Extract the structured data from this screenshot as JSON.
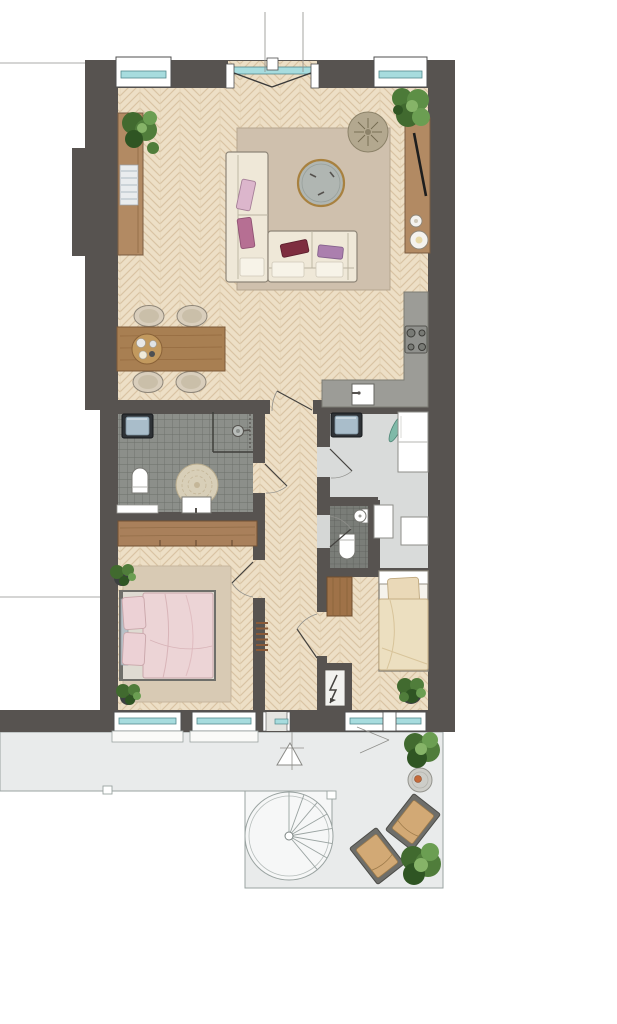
{
  "plan": {
    "type": "apartment-floor-plan",
    "palette": {
      "background": "#ffffff",
      "wall": "#575350",
      "wood_floor": "#eddfc6",
      "wood_floor_line": "#d9c3a3",
      "bath_tile": "#8c8f8a",
      "bath_tile_line": "#6d706b",
      "wc_tile": "#7a7d78",
      "wc_tile_line": "#5c5f5a",
      "utility_floor": "#d9dbda",
      "terrace_floor": "#e9ebeb",
      "outline": "#9aa3a1",
      "window_glass": "#a7dcde",
      "window_frame": "#4f4f4f",
      "wood_furniture": "#b28a63",
      "wood_dark": "#9f7248",
      "table_wood": "#a87f52",
      "counter": "#9c9c97",
      "sofa": "#efe8d8",
      "rug_living": "#cfc0ad",
      "rug_bedroom": "#d8cab4",
      "duvet_pink": "#ecd4d6",
      "duvet_beige": "#ecdfc0",
      "pillow_pink": "#dcb6cc",
      "pillow_mauve": "#b66f93",
      "pillow_wine": "#7e2d3f",
      "pillow_purple": "#ab7fae",
      "plant_green": "#507d3b",
      "plant_green_light": "#6b9e52",
      "pot_dark": "#3c4040",
      "appliance_frame": "#2e3236",
      "appliance_door": "#a9bdca",
      "chair_cushion": "#d2a975",
      "chair_frame": "#6e6e6a",
      "gold_rim": "#a8813f"
    },
    "rooms": [
      {
        "name": "living-room",
        "floor": "herringbone-parquet",
        "furniture": [
          "corner-sofa",
          "round-coffee-table",
          "area-rug",
          "rattan-pouf",
          "sideboard",
          "magazine-stack",
          "dining-table",
          "four-dining-chairs",
          "serving-tray",
          "tv-cabinet",
          "tv",
          "two-speakers",
          "two-plants"
        ]
      },
      {
        "name": "kitchen",
        "floor": "herringbone-parquet",
        "furniture": [
          "l-shaped-counter",
          "cooktop-four-burners",
          "sink-with-faucet"
        ]
      },
      {
        "name": "bathroom",
        "floor": "grey-tiles",
        "furniture": [
          "washing-machine",
          "shower-head",
          "shower-screen",
          "toilet",
          "washbasin",
          "round-mat",
          "bench"
        ]
      },
      {
        "name": "utility-room",
        "floor": "light-grey",
        "furniture": [
          "washing-machine",
          "tall-cabinet",
          "ironing-board",
          "boiler-units"
        ]
      },
      {
        "name": "wc",
        "floor": "dark-grey-tiles",
        "furniture": [
          "toilet",
          "fountain-sink"
        ]
      },
      {
        "name": "hall",
        "floor": "herringbone-parquet",
        "furniture": [
          "coat-rack",
          "meter-cupboard-with-lightning-bolt"
        ]
      },
      {
        "name": "bedroom-1",
        "floor": "herringbone-parquet",
        "furniture": [
          "double-bed-pink-bedding",
          "area-rug",
          "built-in-wardrobe",
          "two-plants"
        ]
      },
      {
        "name": "bedroom-2",
        "floor": "herringbone-parquet",
        "furniture": [
          "single-bed-beige-bedding",
          "wardrobe",
          "plant"
        ]
      },
      {
        "name": "terrace",
        "floor": "light-grey-paving",
        "furniture": [
          "spiral-staircase",
          "two-lounge-chairs",
          "round-side-table",
          "three-plants",
          "door-swing-triangle"
        ]
      }
    ],
    "openings": {
      "top_wall": [
        "window",
        "french-double-door",
        "window"
      ],
      "bottom_wall": [
        "window",
        "window",
        "terrace-door",
        "bedroom2-window-band"
      ],
      "interior_doors": [
        "living-to-hall",
        "hall-to-bathroom",
        "hall-to-utility",
        "hall-to-wc",
        "hall-to-bedroom1",
        "hall-to-bedroom2"
      ]
    }
  }
}
